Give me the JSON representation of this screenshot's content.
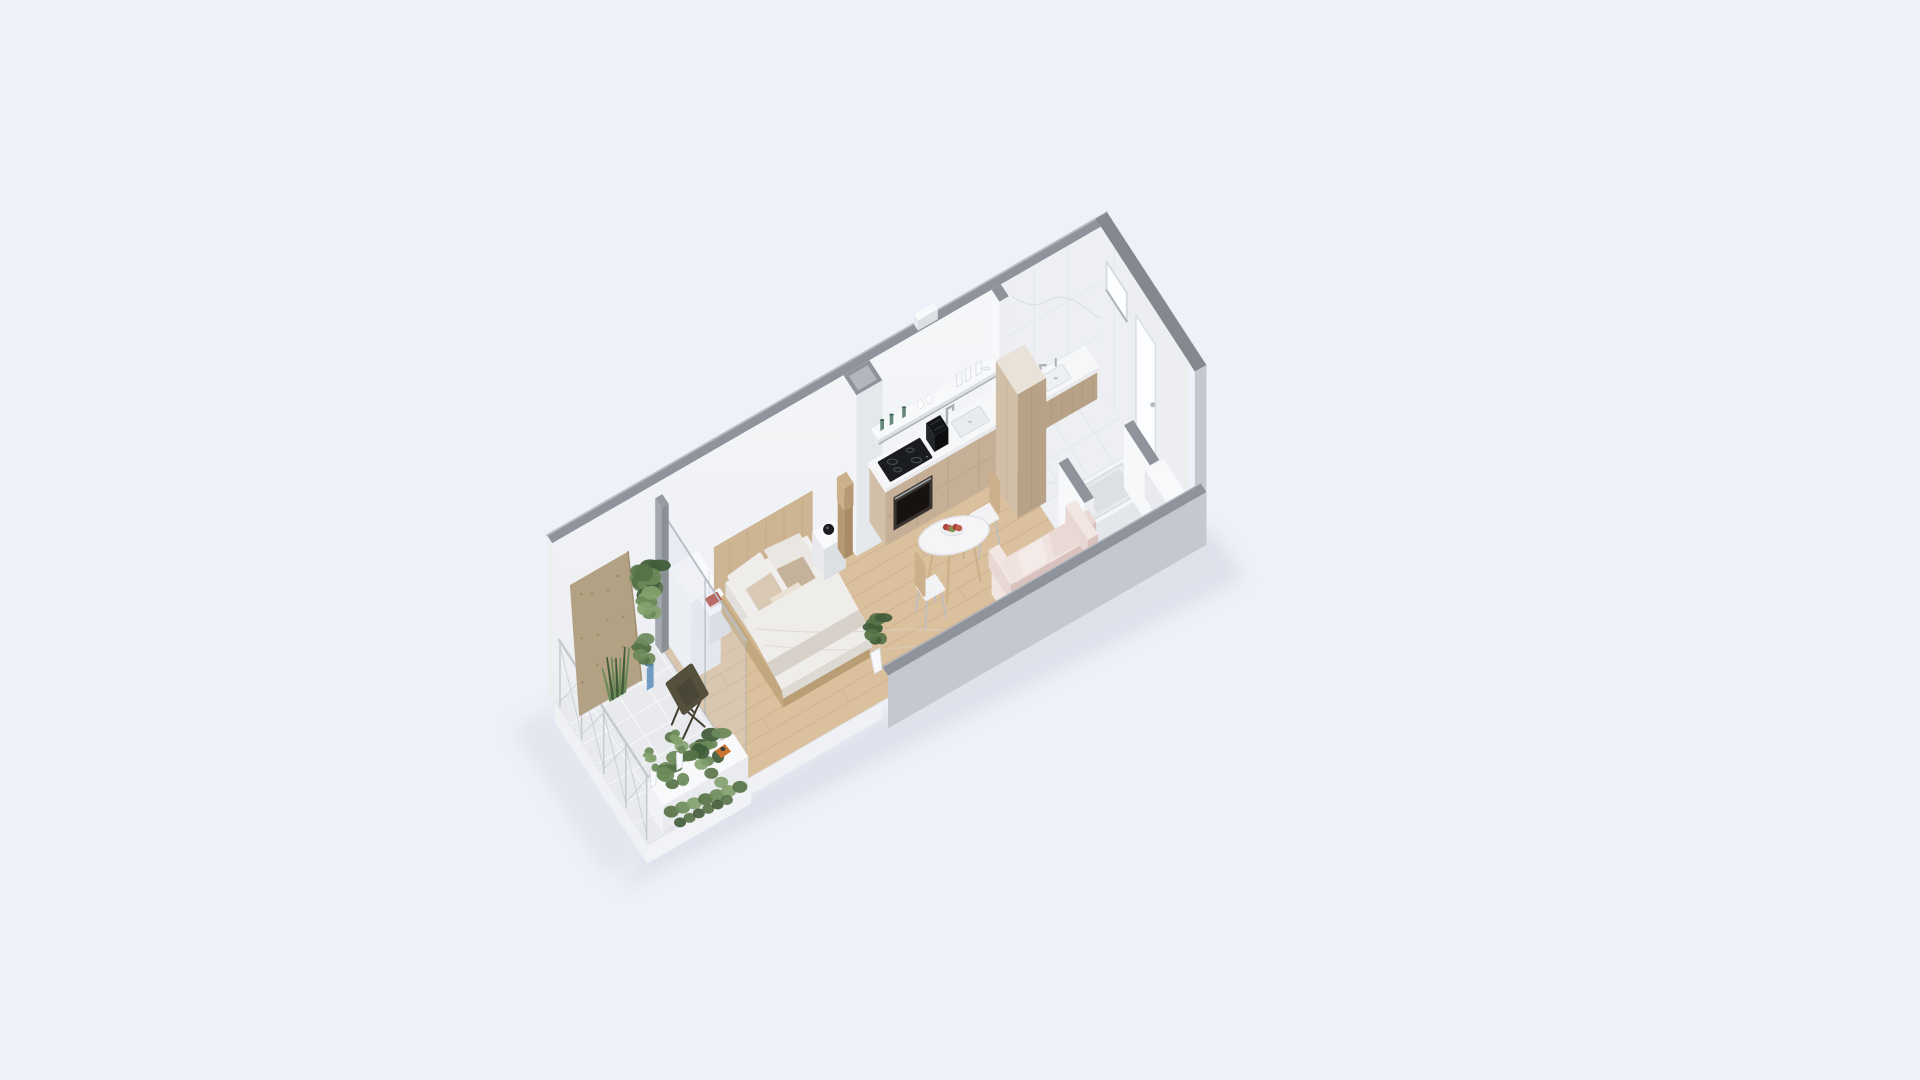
{
  "title": "isometric-studio-apartment-floor-plan-render",
  "palette": {
    "background": "#edf1f9",
    "wallTop": "#8f949c",
    "wallTopDark": "#84898f",
    "wallTopLight": "#b7bcc3",
    "wallFace": "#f7f8fa",
    "wallFaceShade": "#eceef2",
    "wallExterior": "#c5c9cf",
    "floorWood": "#dbc09e",
    "floorWoodLine": "#b08d62",
    "floorTile": "#e8eaed",
    "tileLine": "#f8f9fa",
    "marble": "#edeff3",
    "marbleLine": "#dce0e7",
    "marbleVein": "#cfd4dd",
    "cabinetLight": "#d2bfa8",
    "cabinet": "#c5b097",
    "cabinetDark": "#b7a287",
    "counter": "#f6f7f8",
    "counterEdge": "#e9ebee",
    "appliance": "#1a1c1f",
    "applianceDark": "#101113",
    "ovenBody": "#3a3430",
    "ovenGlass": "#17120f",
    "steel": "#a7aeb5",
    "wood": "#ccb08b",
    "woodDark": "#b79a73",
    "white": "#f8f9fb",
    "whiteShade": "#e8eaee",
    "whiteDark": "#dcdfe4",
    "bedding": "#efedea",
    "beddingShade": "#ddd9d3",
    "pillowTan": "#d9c9b4",
    "pillowDark": "#c4b29a",
    "pillowCream": "#e9e0d2",
    "blanket": "#d5d0c8",
    "sofa": "#e9d7d3",
    "sofaShade": "#d9c2be",
    "sofaLight": "#f2e6e2",
    "leaf1": "#415c39",
    "leaf2": "#567247",
    "leaf3": "#6c8a59",
    "leaf4": "#82a06c",
    "plywood": "#b3a183",
    "plywoodDot": "#8f7d5e",
    "leather": "#55503e",
    "leatherDark": "#423e2f",
    "potBlue": "#6f9cc0",
    "potBlueDark": "#5a83a6",
    "bookRed": "#b0473c",
    "trayOrange": "#c87430",
    "apple1": "#a8443a",
    "apple2": "#c05a4c",
    "apple3": "#7d9752",
    "glassGreen": "#4e7a67",
    "glassClear": "#dfe3e7",
    "shadow": "#c9cfda",
    "railing": "#c6cad0",
    "frameGray": "#979ca4"
  },
  "scene": {
    "layers": [
      {
        "id": "architecture-shell",
        "items": [
          "ground-shadow",
          "balcony-slab",
          "back-wall",
          "wall-vent",
          "interior-wood-floor",
          "bathroom-marble-floor",
          "corridor-wood-floor",
          "right-wall",
          "bathroom-wall-stub"
        ]
      },
      {
        "id": "bathroom",
        "items": [
          "bathroom-window",
          "entry-door",
          "vanity",
          "vanity-sink",
          "vanity-faucet",
          "bathtub",
          "half-wall-left",
          "half-wall-right",
          "entry-bench"
        ]
      },
      {
        "id": "kitchen-living",
        "items": [
          "service-column",
          "kitchen-shelf",
          "shelf-glassware",
          "kitchen-counter",
          "built-in-oven",
          "induction-cooktop",
          "toaster",
          "kitchen-sink",
          "kitchen-faucet",
          "tall-cabinet",
          "dining-chair-right",
          "dining-table",
          "fruit-bowl",
          "dining-chair-left",
          "sofa"
        ]
      },
      {
        "id": "bedroom",
        "items": [
          "wardrobe",
          "headboard-panel",
          "nightstand-left",
          "red-book",
          "double-bed",
          "pillows",
          "duvet",
          "nightstand-right",
          "speaker-sphere",
          "wood-lamp",
          "floor-plant",
          "glass-partition"
        ]
      },
      {
        "id": "front-wall-layer",
        "items": [
          "front-wall"
        ]
      },
      {
        "id": "balcony",
        "items": [
          "balcony-railing",
          "plywood-panel",
          "potted-plant-blue",
          "snake-plant",
          "hanging-plant",
          "butterfly-chair",
          "planter-bench",
          "bench-plants",
          "trailing-plants",
          "floor-pots",
          "orange-tray"
        ]
      }
    ]
  }
}
